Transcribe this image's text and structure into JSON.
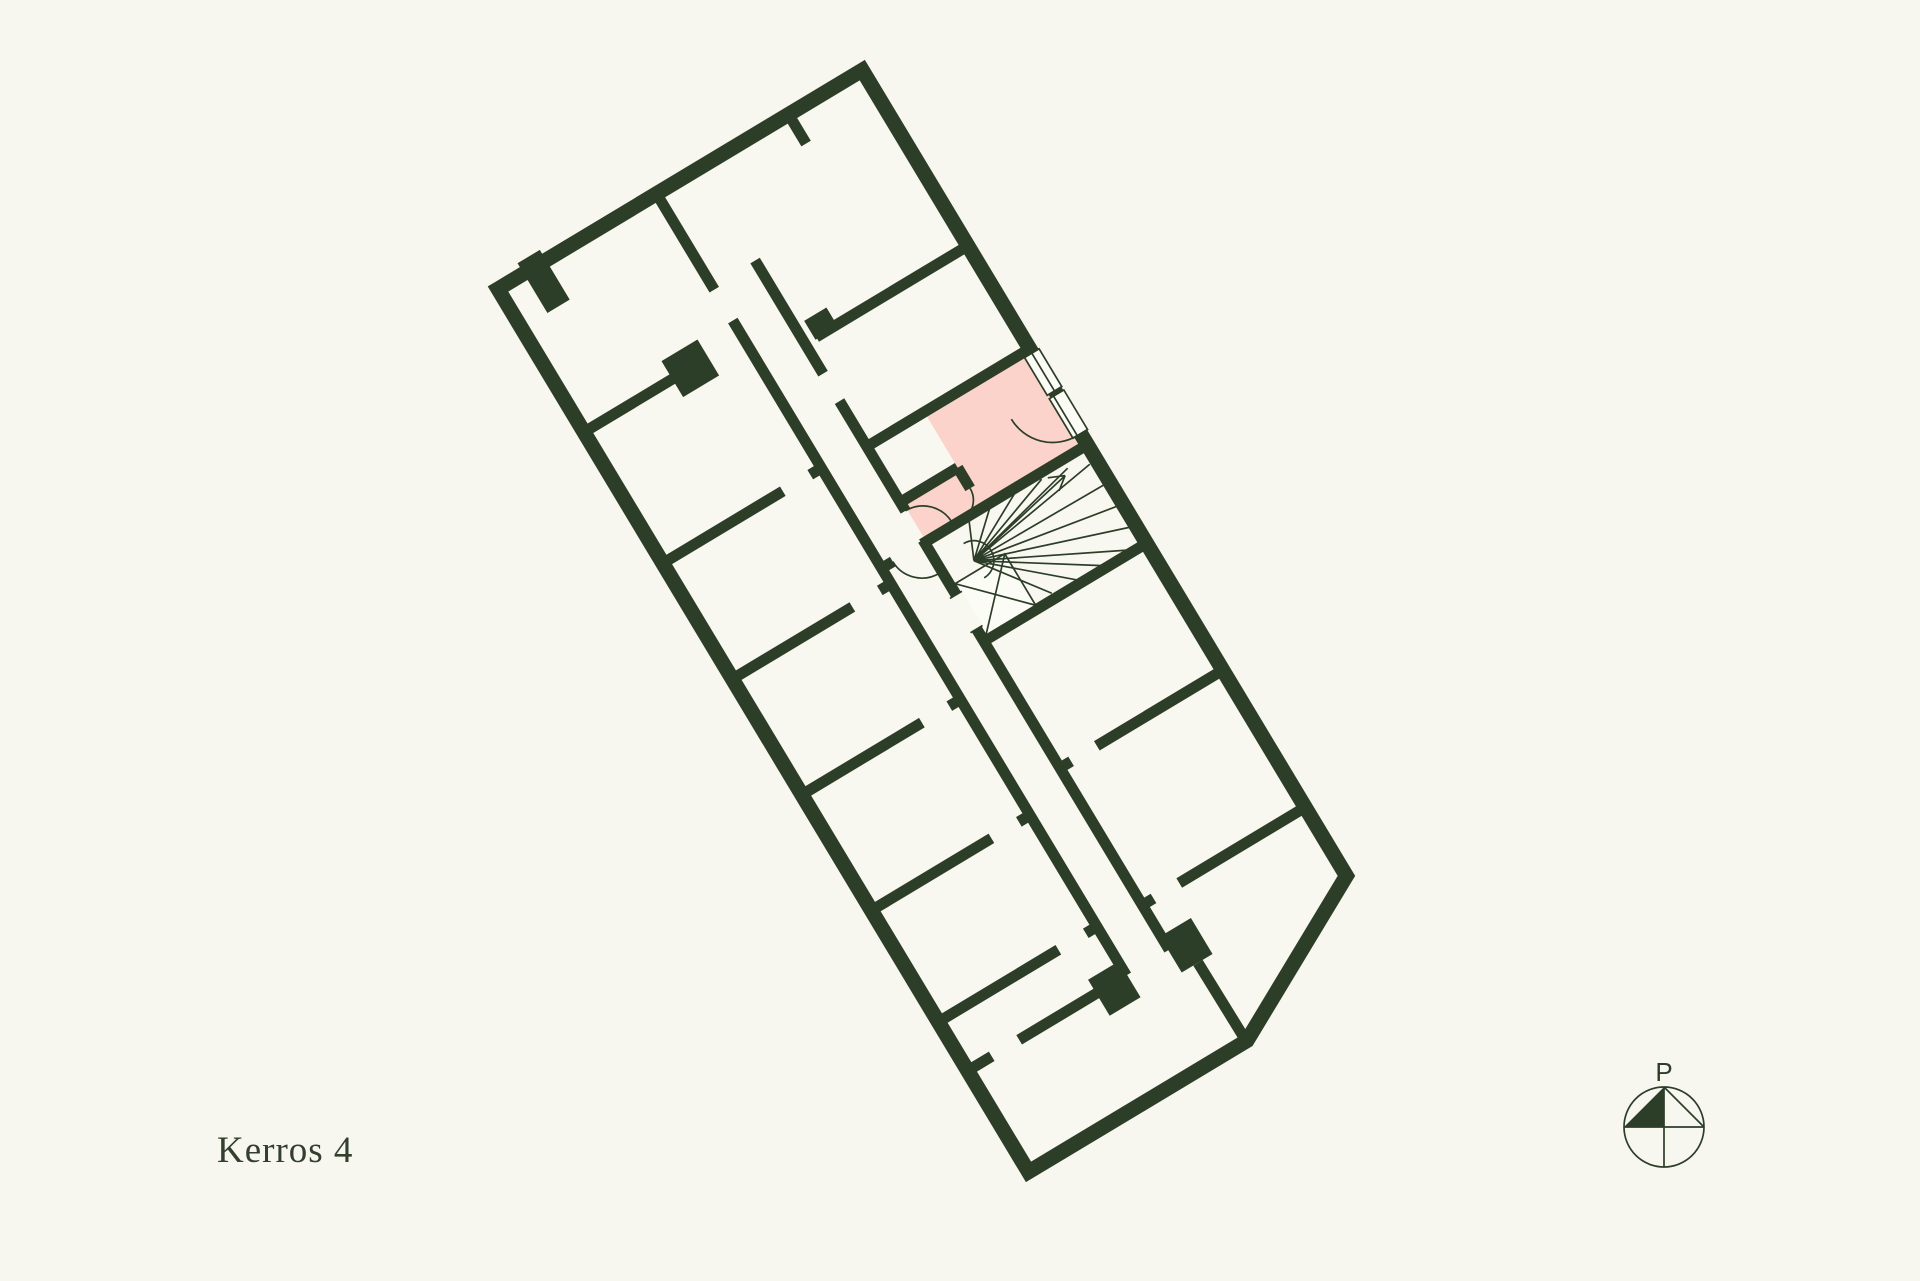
{
  "page": {
    "background_color": "#f7f7f0"
  },
  "floor_plan": {
    "label": "Kerros 4",
    "wall_color": "#2d3e28",
    "room_fill_color": "#f8f8f1",
    "highlight_color": "#fbd3ca",
    "highlighted_apartment": {
      "highlighted": true,
      "fill": "#fbd3ca"
    },
    "features": [
      "corridor",
      "spiral-staircase",
      "elevator-shaft",
      "door-arcs",
      "windows"
    ]
  },
  "compass": {
    "label": "P"
  }
}
